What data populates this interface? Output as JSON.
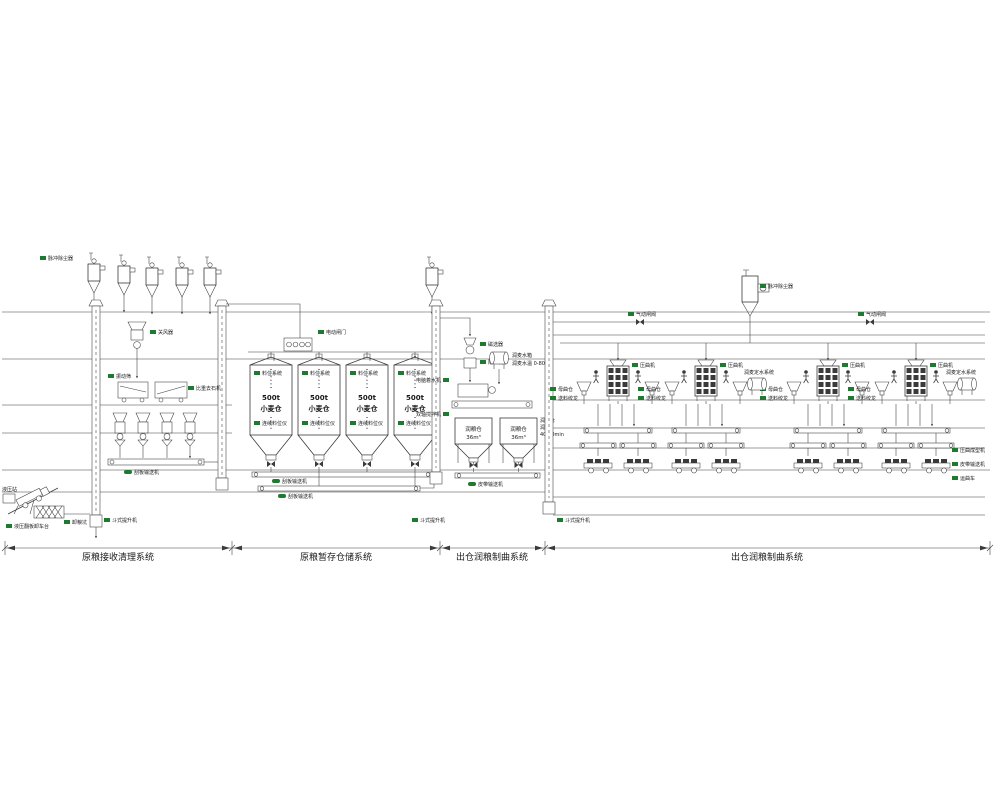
{
  "diagram": {
    "sections": [
      {
        "id": "receiving",
        "title": "原粮接收清理系统"
      },
      {
        "id": "storage",
        "title": "原粮暂存仓储系统"
      },
      {
        "id": "moistening",
        "title": "出仓润粮制曲系统"
      },
      {
        "id": "koji",
        "title": "出仓润粮制曲系统"
      }
    ]
  },
  "silo": {
    "capacity": "500t",
    "name": "小麦仓",
    "level_system": "料位系统",
    "level_gauge": "连续料位仪"
  },
  "receiving": {
    "dust_collector": "脉冲除尘器",
    "rotary_valve": "关风器",
    "vibrating_screen": "振动筛",
    "destoner": "比重去石机",
    "scraper_conveyor": "刮板输送机",
    "bucket_elevator": "斗式提升机",
    "truck_tipper": "液压翻板卸车台",
    "unloading_pit": "卸粮坑",
    "hydraulic_station": "液压站"
  },
  "storage": {
    "electric_gate": "电动闸门",
    "scraper_conveyor": "刮板输送机"
  },
  "moistening": {
    "magnetic_separator": "磁选器",
    "deawner": "除芒机",
    "computer_water_machine": "电脑着水机",
    "twin_shaft_mixer": "双轴搅拌机",
    "water_tank": "润麦水箱",
    "water_temp": "润麦水温 0-80℃",
    "bin_name": "润粮仓",
    "bin_volume": "36m³",
    "note_process": "润粮",
    "note_time": "40-60min",
    "belt_conveyor": "皮带输送机",
    "bucket_elevator": "斗式提升机"
  },
  "koji": {
    "pneumatic_valve": "气动闸阀",
    "dust_collector": "脉冲除尘器",
    "mother_bin": "母曲仓",
    "feed_screw": "送料绞龙",
    "press": "压曲机",
    "water_system": "润麦定水系统",
    "press_forming": "压曲成型机",
    "belt_conveyor": "皮带输送机",
    "transport_cart": "运曲车"
  },
  "colors": {
    "line": "#3a3a3a",
    "tag": "#1e7a2e",
    "text": "#1a1a1a"
  }
}
